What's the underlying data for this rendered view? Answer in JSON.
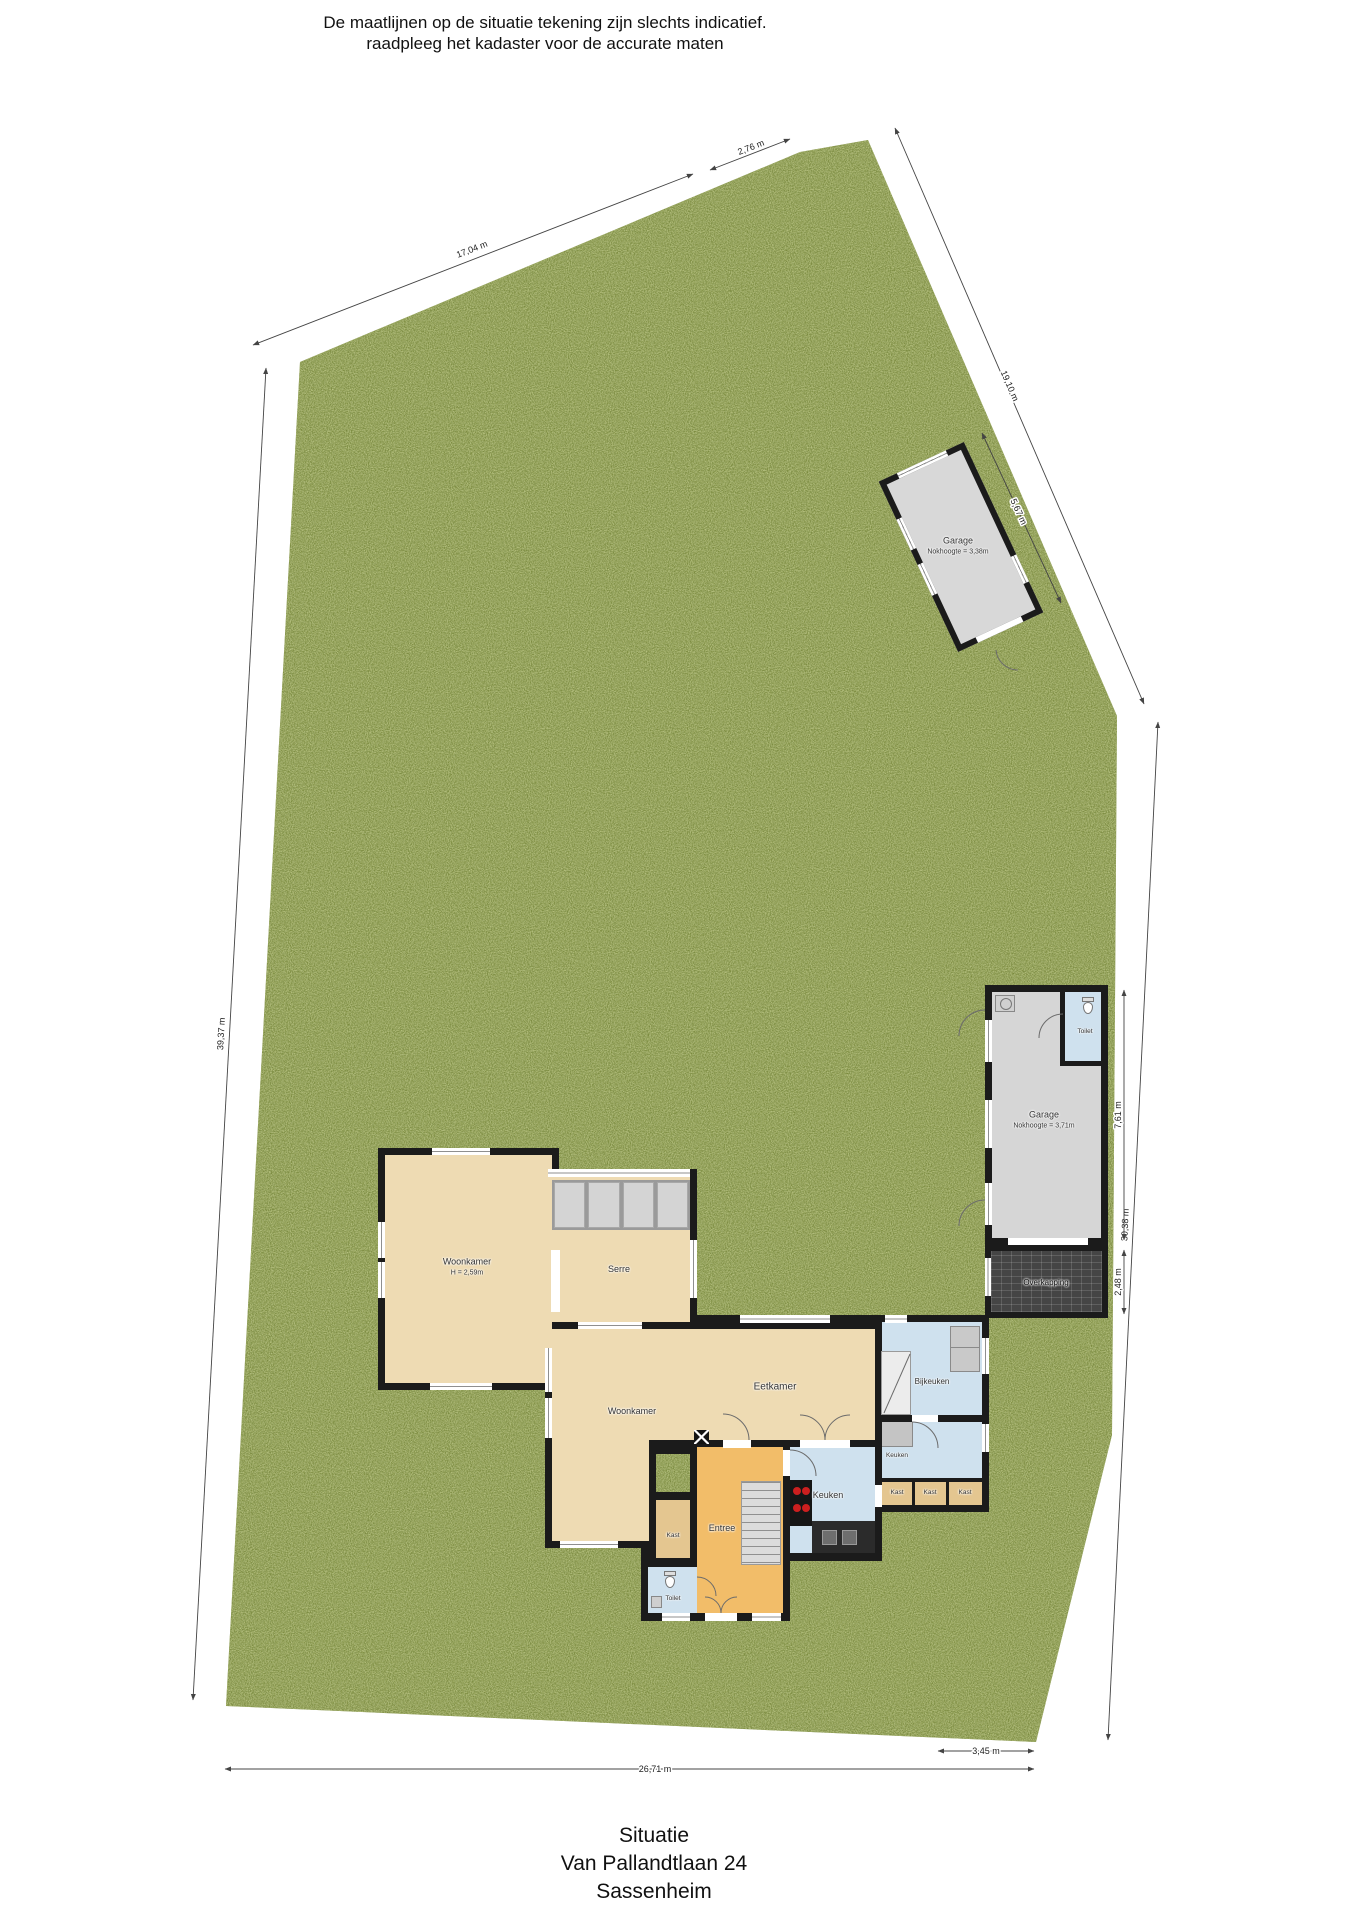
{
  "disclaimer": {
    "line1": "De maatlijnen op de situatie tekening zijn slechts indicatief.",
    "line2": "raadpleeg het kadaster voor de accurate maten"
  },
  "footer": {
    "line1": "Situatie",
    "line2": "Van Pallandtlaan 24",
    "line3": "Sassenheim"
  },
  "dimensions": {
    "top_left_long": "17,04 m",
    "top_left_short": "2,76 m",
    "top_right_long": "19,10 m",
    "garage_top_side": "5,67 m",
    "left_edge": "39,37 m",
    "right_edge": "30,38 m",
    "bottom_edge": "26,71 m",
    "bottom_right": "3,45 m",
    "garage_right_height": "7,61 m",
    "overkapping_height": "2,48 m"
  },
  "upper_garage": {
    "name": "Garage",
    "height_note": "Nokhoogte = 3,38m"
  },
  "right_garage": {
    "name": "Garage",
    "height_note": "Nokhoogte = 3,71m",
    "toilet": "Toilet",
    "overkapping": "Overkapping"
  },
  "house": {
    "woonkamer_nw": {
      "name": "Woonkamer",
      "height_note": "H = 2,59m"
    },
    "serre": "Serre",
    "eetkamer": "Eetkamer",
    "woonkamer": "Woonkamer",
    "bijkeuken": "Bijkeuken",
    "keuken_pantry": "Keuken",
    "keuken": "Keuken",
    "entree": "Entree",
    "kast_hal": "Kast",
    "toilet": "Toilet",
    "kast_1": "Kast",
    "kast_2": "Kast",
    "kast_3": "Kast"
  },
  "colors": {
    "grass": "#7a8a3e",
    "wall": "#1b1b1b",
    "floor_tan": "#eedbb3",
    "floor_orange": "#f2bd69",
    "floor_blue": "#cfe1ee",
    "floor_gray": "#d6d6d6",
    "kast_tan": "#e4c690",
    "overkapping": "#454545"
  }
}
